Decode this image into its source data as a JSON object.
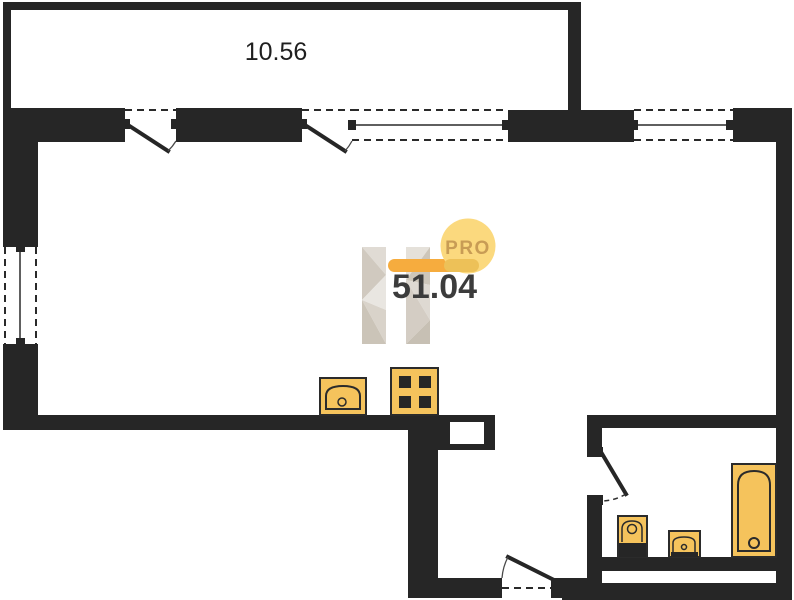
{
  "plan": {
    "balcony": {
      "area_label": "10.56"
    },
    "apartment": {
      "area_label": "51.04"
    },
    "watermark": {
      "brand": "PRO"
    }
  },
  "fixtures": [
    {
      "icon": "kitchen-sink-icon"
    },
    {
      "icon": "stove-icon"
    },
    {
      "icon": "toilet-icon"
    },
    {
      "icon": "washbasin-icon"
    },
    {
      "icon": "bathtub-icon"
    }
  ],
  "colors": {
    "background": "#FFFFFF",
    "wall": "#262626",
    "fixture_fill": "#F5C35C",
    "fixture_stroke": "#2B2B2B",
    "logo_circle": "#FBD97E",
    "logo_bar": "#F6AC3E",
    "logo_bar_overlap": "#EDC158",
    "logo_text": "#C89C55",
    "area_text": "#3C3C3C",
    "balcony_text": "#1F1F1F",
    "watermark_light": "#E6E2DC",
    "watermark_mid": "#D5CFC7",
    "watermark_dark": "#C6BEB2"
  }
}
